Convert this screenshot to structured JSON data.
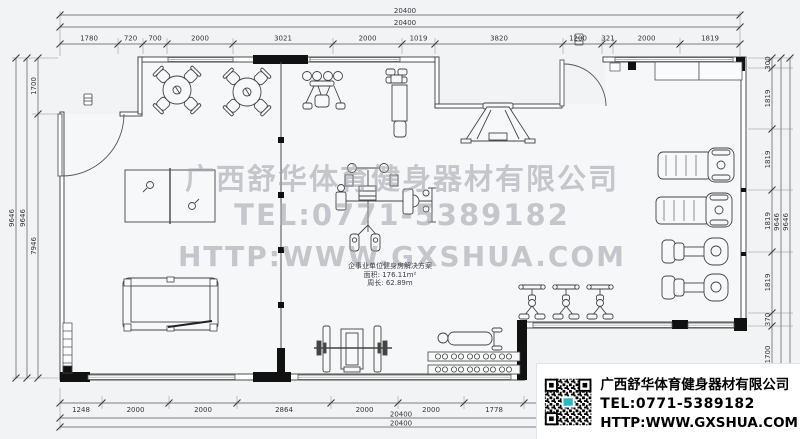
{
  "plan": {
    "watermark": {
      "company": "广西舒华体育健身器材有限公司",
      "tel": "TEL:0771-5389182",
      "web": "HTTP:WWW.GXSHUA.COM"
    },
    "room_label": {
      "title": "企事业单位健身房解决方案",
      "area": "面积: 176.11m²",
      "perimeter": "周长: 62.89m"
    },
    "info_box": {
      "company": "广西舒华体育健身器材有限公司",
      "tel": "TEL:0771-5389182",
      "web": "HTTP:WWW.GXSHUA.COM",
      "qr_icon": "qr-code-icon"
    },
    "dims": {
      "top_overall": [
        "20400",
        "20400"
      ],
      "top": [
        "1780",
        "720",
        "700",
        "2000",
        "3021",
        "2000",
        "1019",
        "3820",
        "1200",
        "321",
        "2000",
        "1819"
      ],
      "bottom": [
        "1248",
        "2000",
        "2000",
        "2864",
        "2000",
        "2000",
        "1778"
      ],
      "bottom_overall": [
        "20400",
        "20400"
      ],
      "left_overall": [
        "9646",
        "9646"
      ],
      "left": [
        "1700",
        "7946"
      ],
      "right_overall": [
        "9646",
        "9646"
      ],
      "right": [
        "300",
        "1819",
        "1819",
        "1819",
        "1819",
        "370",
        "1700"
      ]
    },
    "equipment": [
      "dining-table-with-chairs",
      "dining-table-with-chairs",
      "table-tennis-table",
      "billiard-table",
      "pec-deck-machine",
      "lat-pulldown-machine",
      "squat-rack",
      "multi-station-gym",
      "treadmill",
      "treadmill",
      "recumbent-bike",
      "recumbent-bike",
      "spin-bike",
      "spin-bike",
      "spin-bike",
      "bench-press",
      "flat-bench",
      "dumbbell-rack",
      "storage-cabinet",
      "water-dispenser"
    ],
    "colors": {
      "background": "#f2f3f5",
      "line": "#3a3a3a",
      "wall_black": "#111111",
      "watermark": "#9b9fa8",
      "info_text": "#000000",
      "qr_logo": "#2ab7c6"
    }
  }
}
